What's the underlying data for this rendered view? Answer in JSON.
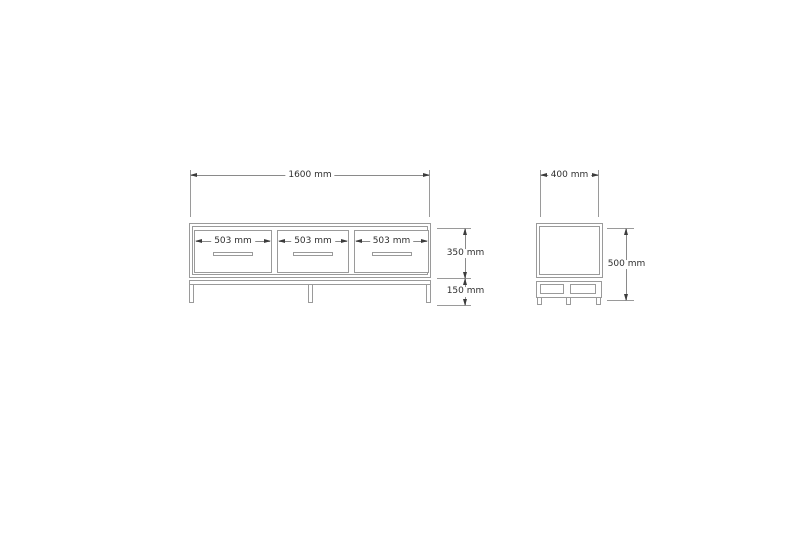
{
  "drawing": {
    "type": "furniture-technical-drawing",
    "front_view": {
      "overall_width_label": "1600 mm",
      "drawers": [
        {
          "width_label": "503 mm"
        },
        {
          "width_label": "503 mm"
        },
        {
          "width_label": "503 mm"
        }
      ],
      "body_height_label": "350 mm",
      "leg_height_label": "150 mm"
    },
    "side_view": {
      "depth_label": "400 mm",
      "overall_height_label": "500 mm"
    },
    "colors": {
      "background": "#ffffff",
      "furniture_line": "#9a9a9a",
      "dimension_line": "#8a8a8a",
      "arrow": "#3c3c3c",
      "text": "#2f2f2f"
    }
  }
}
